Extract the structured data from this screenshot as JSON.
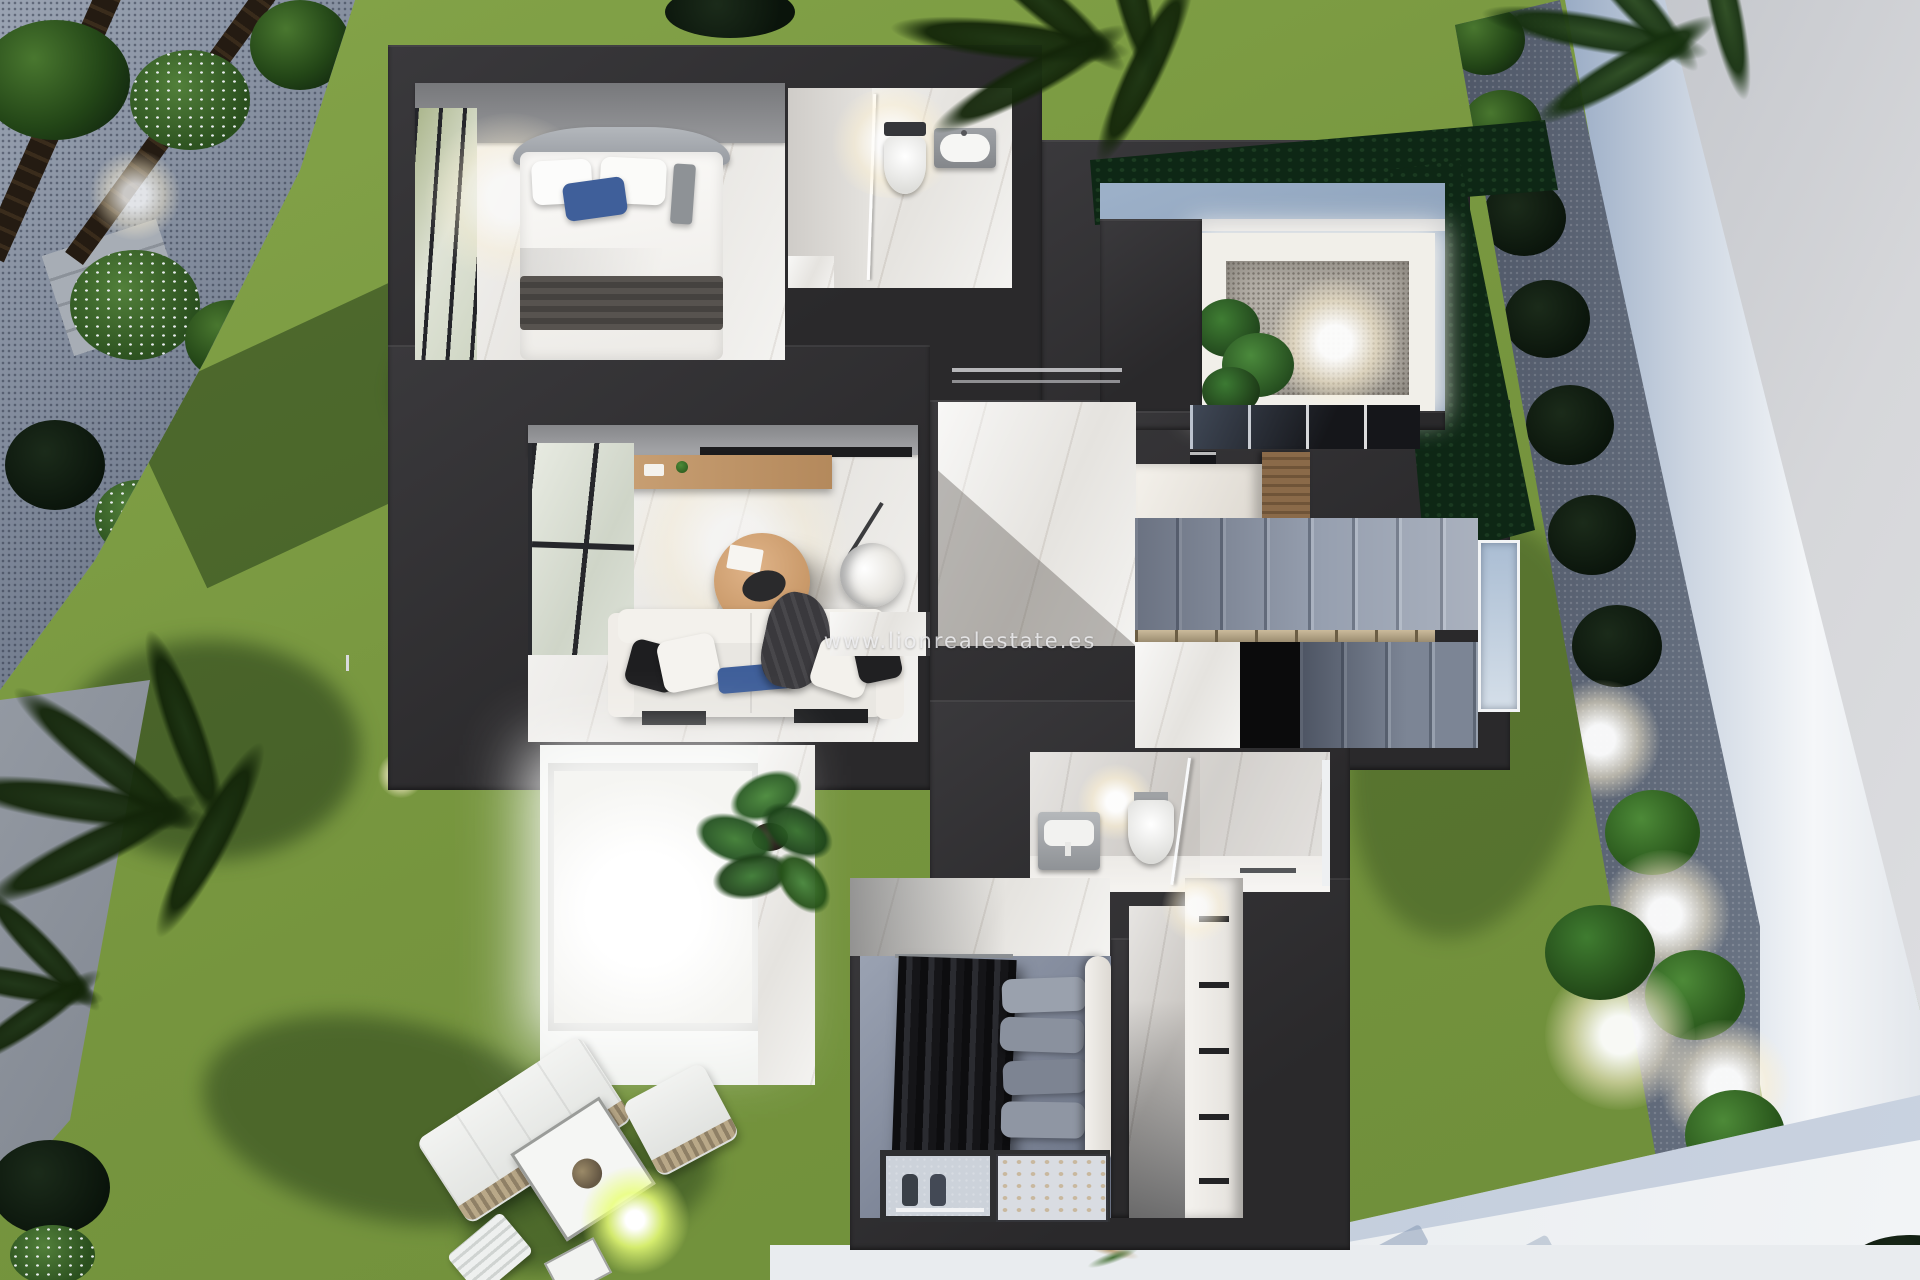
{
  "watermark": {
    "text": "www.lionrealestate.es"
  },
  "colors": {
    "wall": "#302f31",
    "lawn": "#7b9a41",
    "lawn-light": "#8cab4e",
    "lawn-shadow": "#2c4b20",
    "gravel": "#8f99a9",
    "gravel-dark": "#626b7c",
    "hedge": "#0e2715",
    "pavement": "#c7c9ce",
    "pavement-light": "#dbdcdf",
    "wall-white": "#f3f5f7",
    "wall-blue": "#9db1c9",
    "walkway": "#edf0f2",
    "marble": "#f0efec",
    "marble-dim": "#dad7d3",
    "gray-wall": "#8e8f92",
    "steps": "#97a0b0",
    "steps-dark": "#78828f",
    "wood": "#c49c70",
    "wood-dark": "#876746",
    "glass-green": "#cfd6c6",
    "glass-blue": "#aabdd3",
    "sofa": "#e9e7e2",
    "pillow-blue": "#3f5f9a",
    "fabric-dark": "#232325",
    "bed-throw": "#4e4b49",
    "floor-blue": "#8b94a6",
    "court-gravel": "#b5b0a8",
    "band-blue": "#8fa7c6",
    "plant": "#3c7a33",
    "plant-dark": "#1d3a17",
    "glow-warm": "#ffdca8",
    "glow-green": "#def06a"
  }
}
